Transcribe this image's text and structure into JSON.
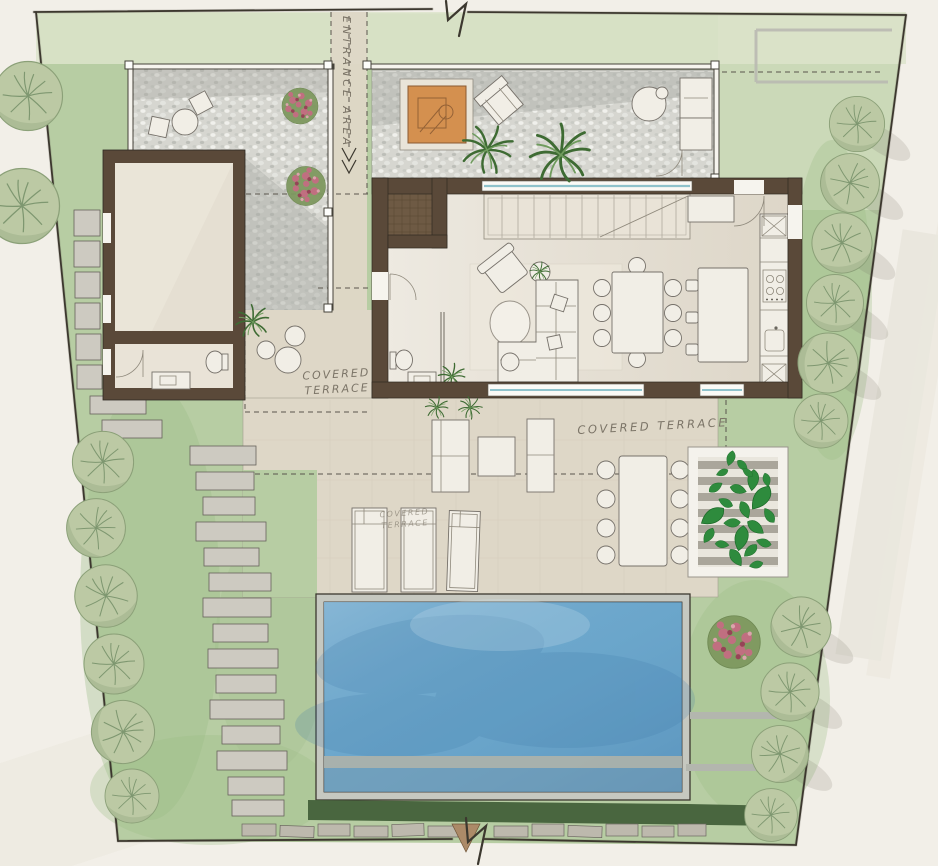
{
  "drawing": {
    "labels": {
      "entrance_area": "ENTRANCE AREA",
      "terrace_left": {
        "line1": "COVERED",
        "line2": "TERRACE"
      },
      "terrace_right": "COVERED TERRACE",
      "terrace_small": {
        "line1": "COVERED",
        "line2": "TERRACE"
      }
    },
    "colors": {
      "paper": "#f2efe8",
      "lawn": "#b7cda3",
      "lawn_light": "#dde4cb",
      "gravel": "#d6d6d0",
      "terrace": "#ded7c7",
      "floor": "#e5dfd2",
      "wall_brown": "#5a4939",
      "ink": "#3c382f",
      "pool_water": "#6ba6cb",
      "coping": "#c6c8c0",
      "tree": "#bcc9a4",
      "ivy": "#2e8b3d",
      "hedge": "#49663f",
      "accent_orange": "#d4904f",
      "flower_pink": "#c06f80"
    }
  }
}
